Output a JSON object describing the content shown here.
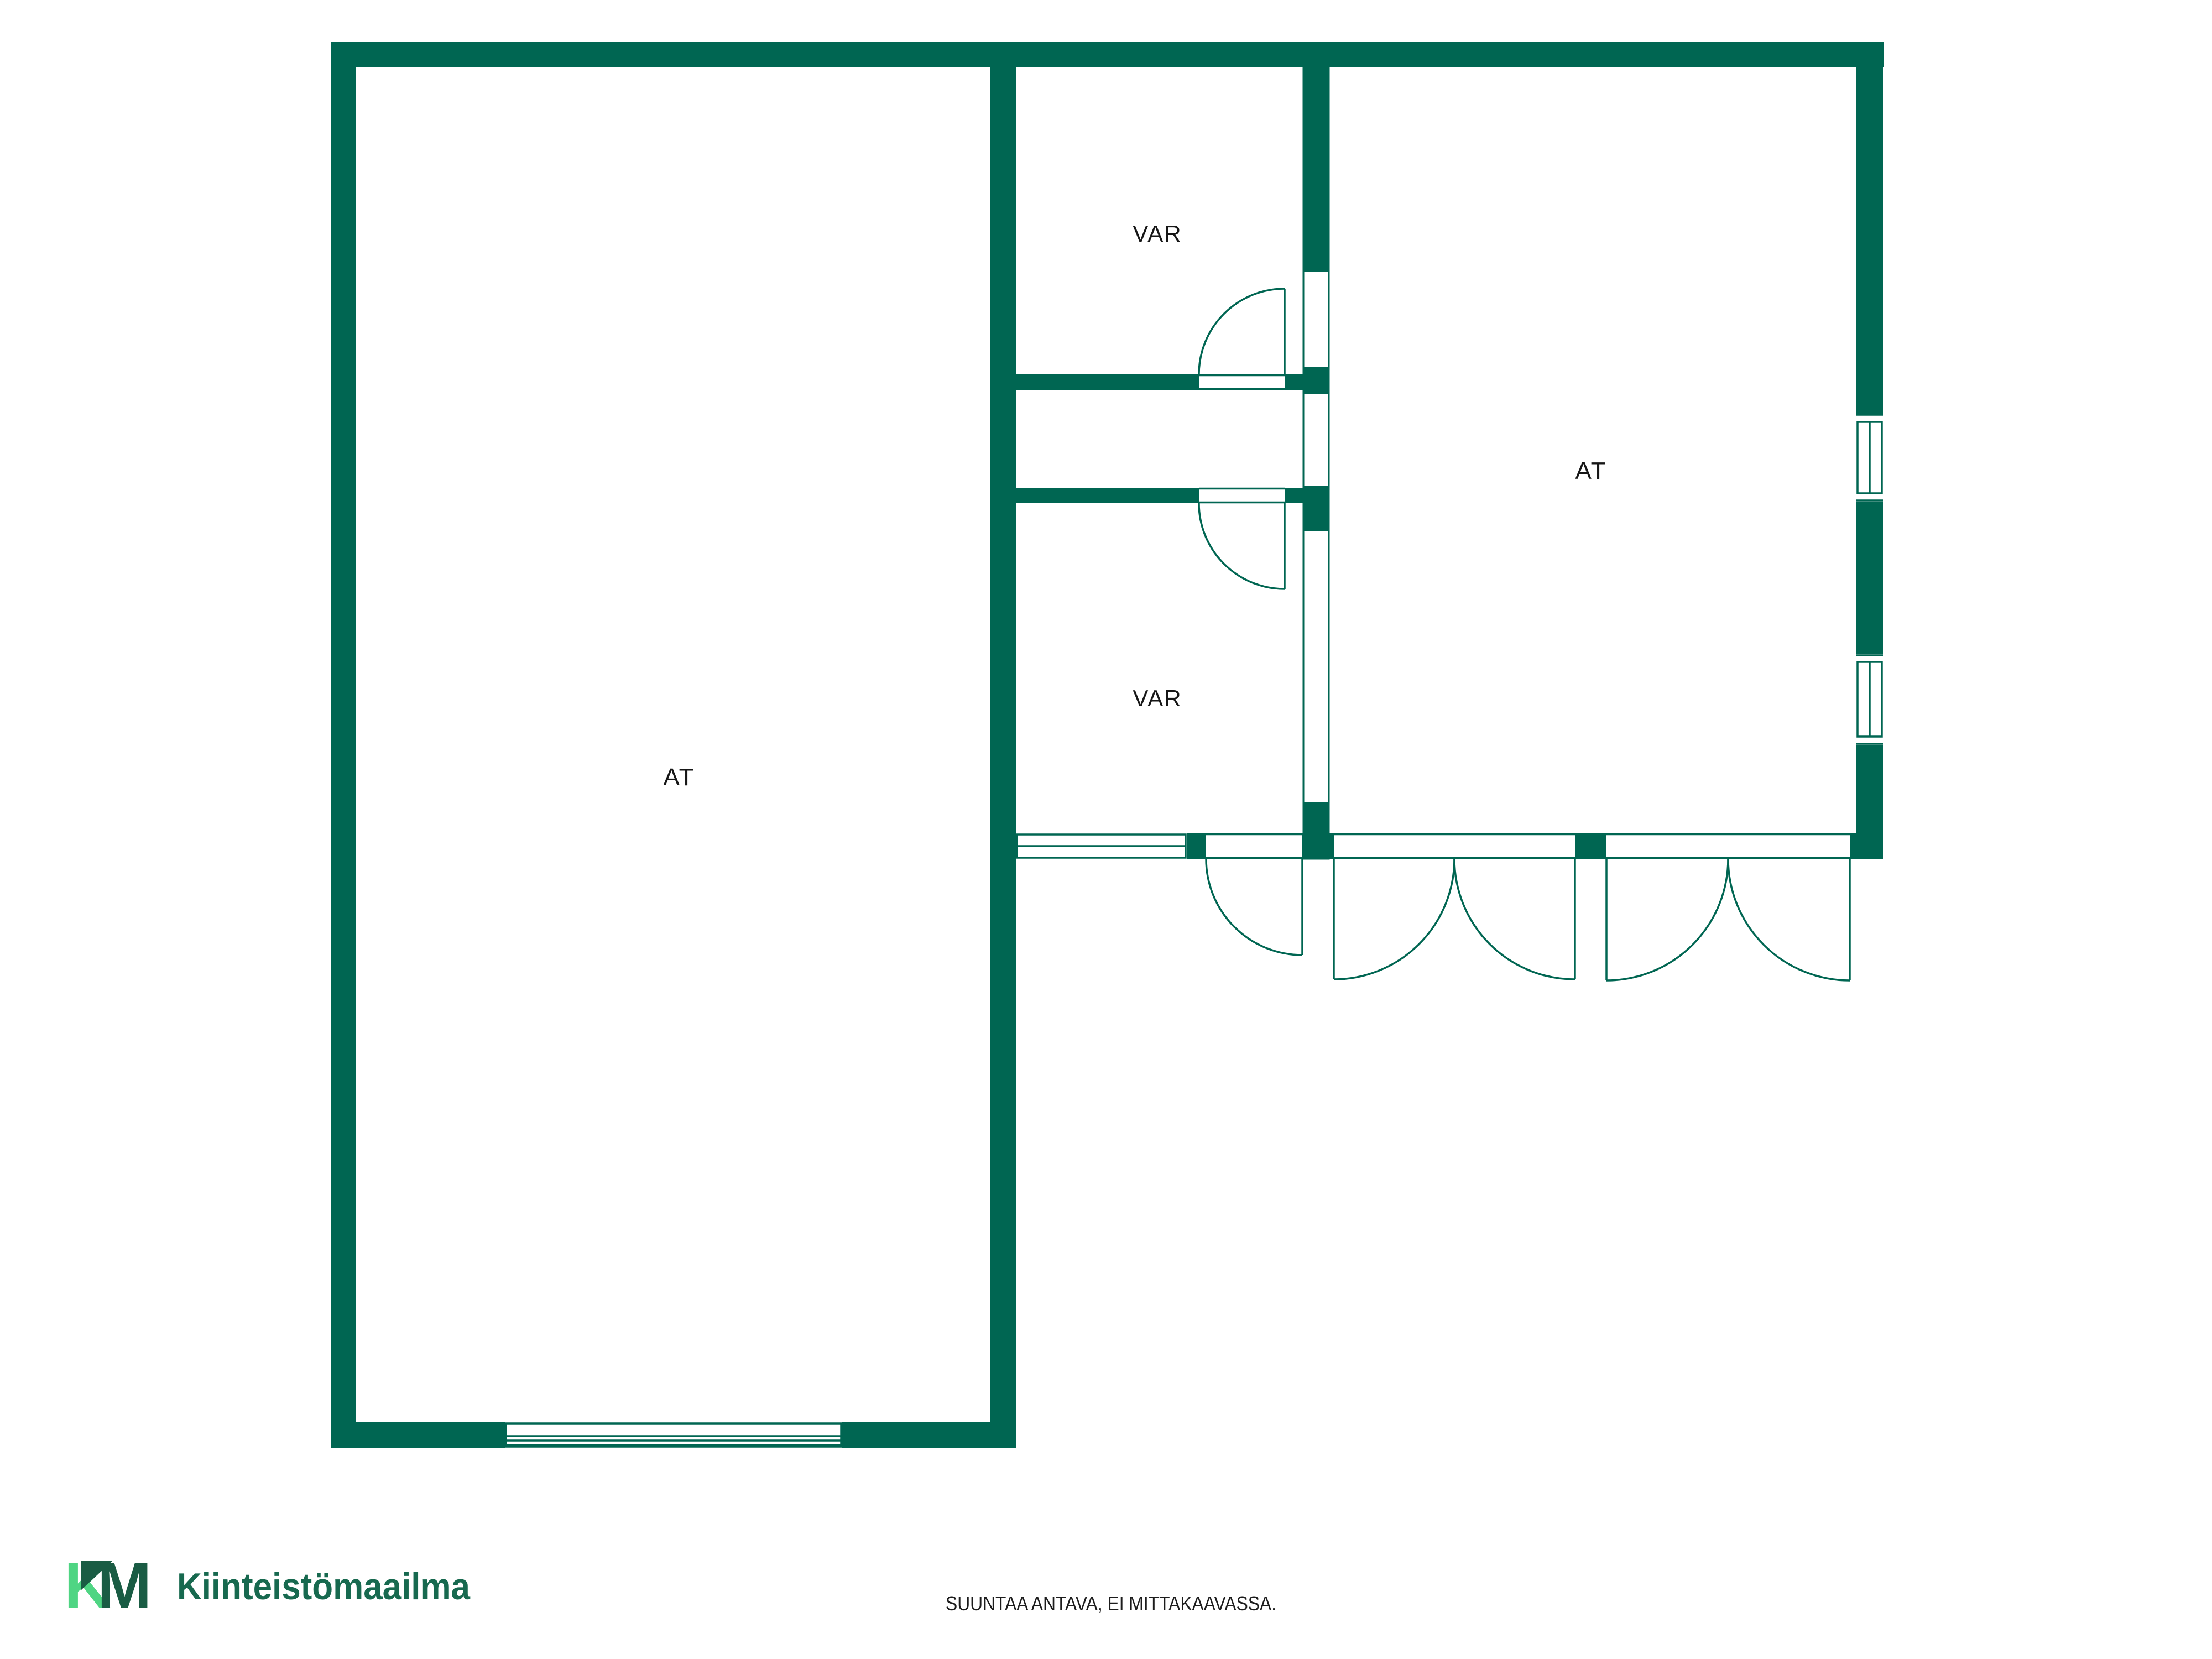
{
  "plan": {
    "wall_color": "#006652",
    "label_color": "#161616",
    "rooms": [
      {
        "id": "left",
        "label": "AT"
      },
      {
        "id": "storage-top",
        "label": "VAR"
      },
      {
        "id": "storage-bottom",
        "label": "VAR"
      },
      {
        "id": "right",
        "label": "AT"
      }
    ]
  },
  "footer": {
    "disclaimer": "SUUNTAA ANTAVA, EI MITTAKAAVASSA.",
    "color": "#1c1c1c"
  },
  "logo": {
    "mark_k": "K",
    "mark_m": "M",
    "name": "Kiinteistömaailma",
    "dark_green": "#1A5C44",
    "light_green": "#4FD583",
    "text_color": "#17694F"
  }
}
